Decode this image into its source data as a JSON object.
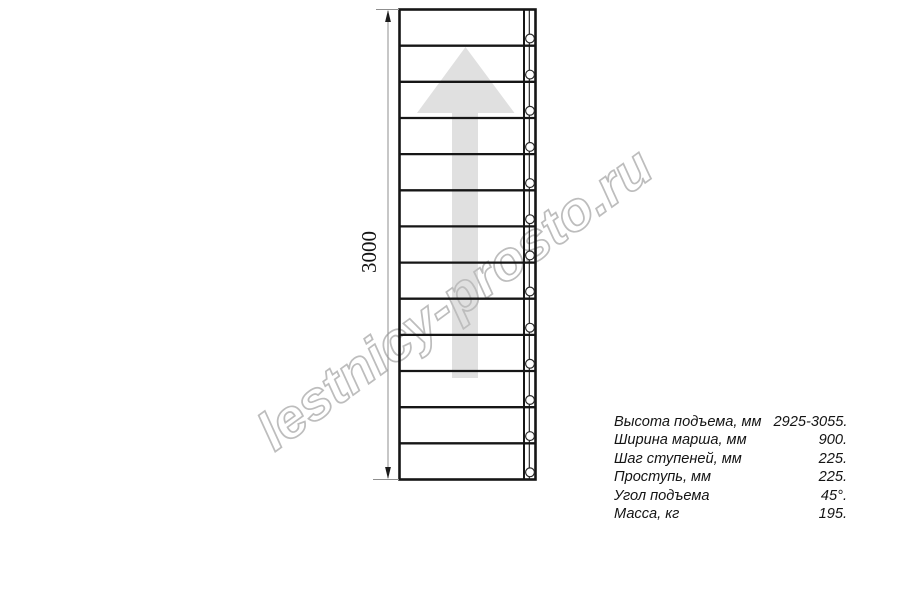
{
  "drawing": {
    "dimension_label": "3000",
    "segments": 13,
    "bolt_count": 13
  },
  "watermark": {
    "text": "lestnicy-prosto.ru"
  },
  "specs": {
    "rows": [
      {
        "label": "Высота подъема, мм",
        "value": "2925-3055."
      },
      {
        "label": "Ширина марша, мм",
        "value": "900."
      },
      {
        "label": "Шаг ступеней, мм",
        "value": "225."
      },
      {
        "label": "Проступь, мм",
        "value": "225."
      },
      {
        "label": "Угол подъема",
        "value": "45°."
      },
      {
        "label": "Масса, кг",
        "value": "195."
      }
    ]
  },
  "colors": {
    "line": "#161616",
    "arrow_fill": "#e0e0e0",
    "watermark_stroke": "#bdbdbd",
    "dim_line": "#8f8f8f",
    "circle_stroke": "#2a2a2a"
  }
}
